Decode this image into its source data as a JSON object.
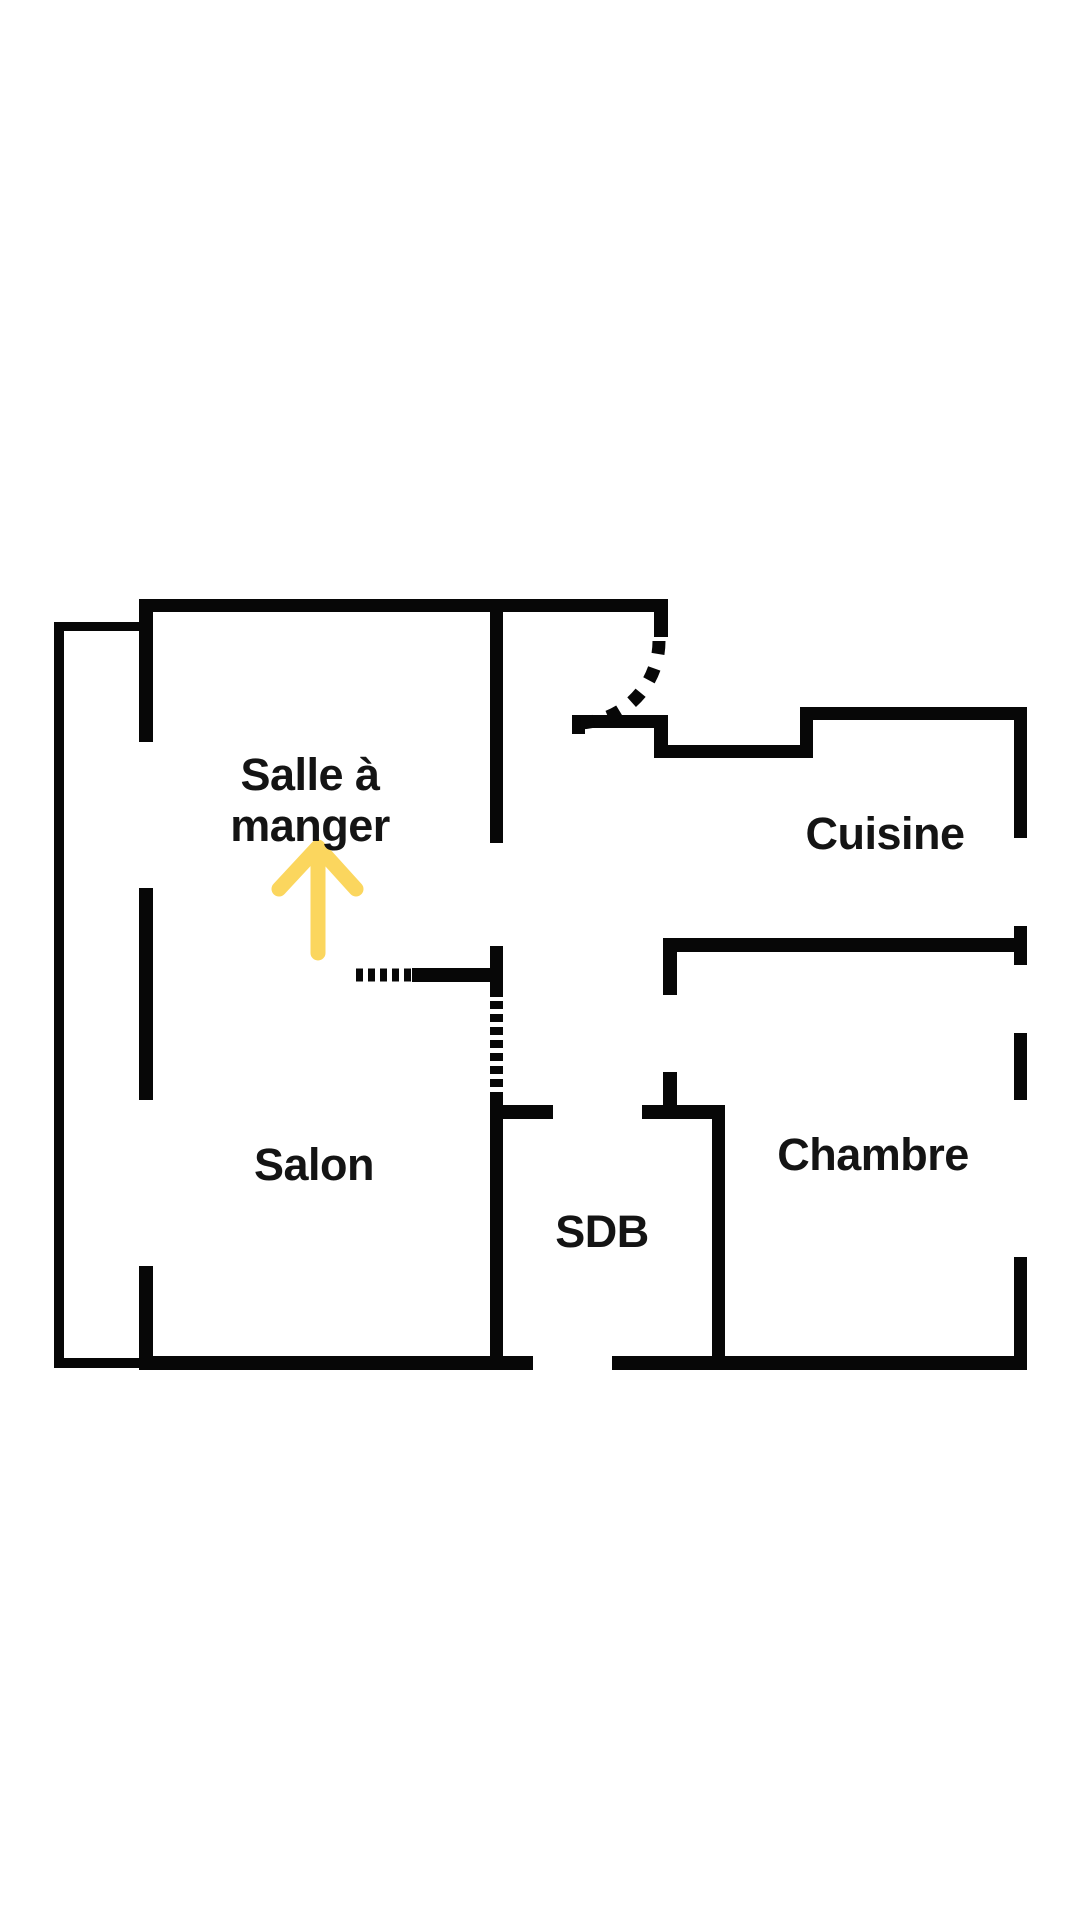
{
  "floorplan": {
    "rooms": {
      "dining": {
        "line1": "Salle à",
        "line2": "manger"
      },
      "kitchen": {
        "label": "Cuisine"
      },
      "living": {
        "label": "Salon"
      },
      "bathroom": {
        "label": "SDB"
      },
      "bedroom": {
        "label": "Chambre"
      }
    },
    "annotation_arrow": {
      "icon": "up-arrow-icon",
      "direction": "up",
      "points_to": "Salle à manger",
      "color": "#FBD65E"
    },
    "colors": {
      "walls": "#070707",
      "text": "#141414",
      "background": "#FFFFFF"
    }
  }
}
